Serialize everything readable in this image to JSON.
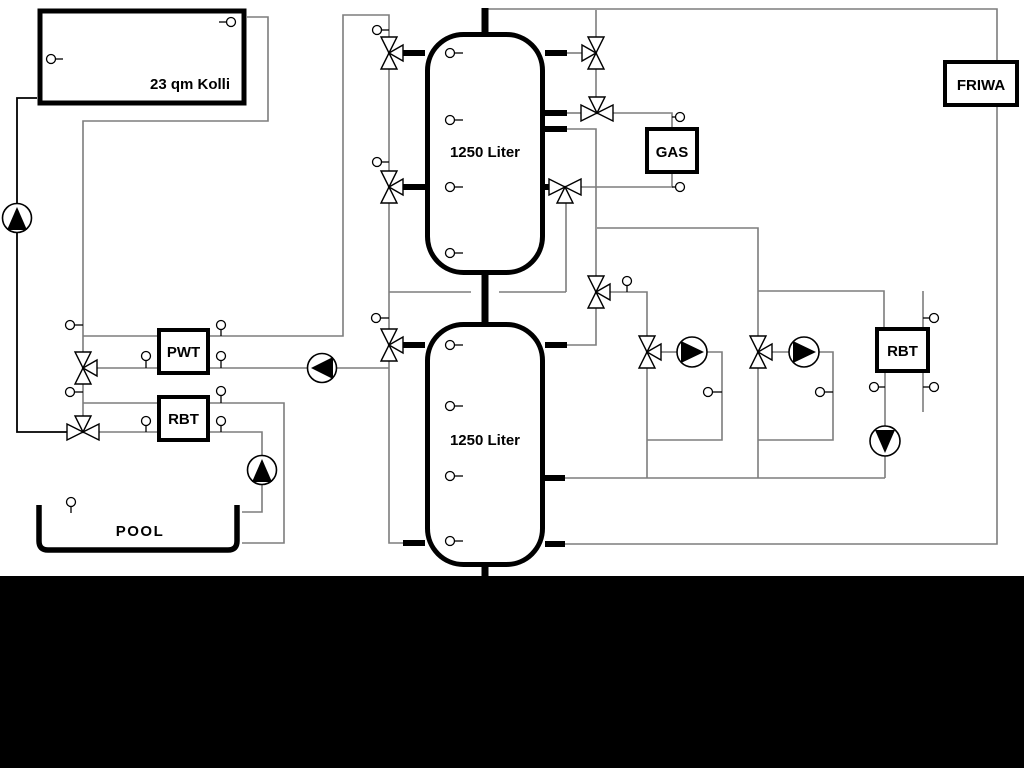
{
  "diagram": {
    "background_color": "#ffffff",
    "pipe_color": "#7d7d7d",
    "outline_color": "#000000",
    "bottom_band_color": "#000000",
    "labels": {
      "collector": "23 qm Kolli",
      "tank1": "1250 Liter",
      "tank2": "1250 Liter",
      "pwt": "PWT",
      "rbt_left": "RBT",
      "gas": "GAS",
      "friwa": "FRIWA",
      "rbt_right": "RBT",
      "pool": "POOL"
    }
  }
}
